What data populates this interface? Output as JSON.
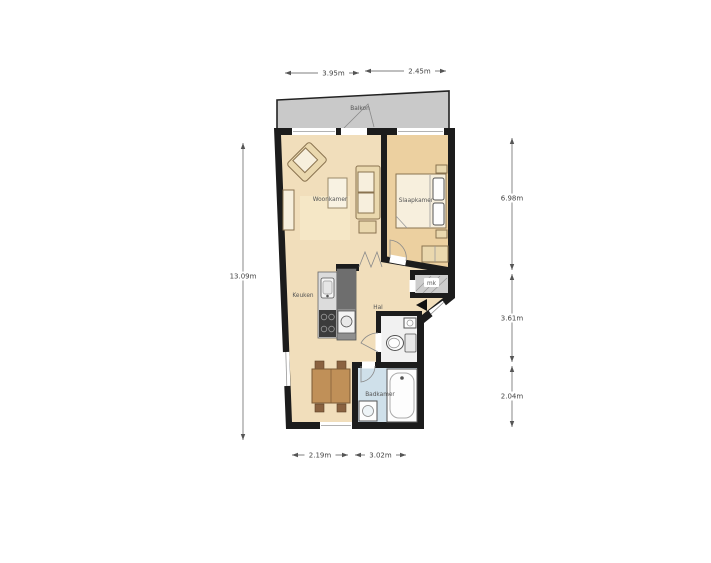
{
  "plan": {
    "rooms": {
      "balcony": "Balkon",
      "living_room": "Woonkamer",
      "bedroom": "Slaapkamer",
      "kitchen": "Keuken",
      "hall": "Hal",
      "bathroom": "Badkamer",
      "meter_closet": "mk"
    },
    "dimensions": {
      "top_left": "3.95m",
      "top_right": "2.45m",
      "left_total": "13.09m",
      "right_upper": "6.98m",
      "right_middle": "3.61m",
      "right_lower": "2.04m",
      "bottom_left": "2.19m",
      "bottom_right": "3.02m"
    },
    "colors": {
      "wall": "#1c1c1c",
      "floor_main": "#f1debb",
      "floor_bedroom": "#ecd0a0",
      "floor_bathroom": "#cfe0ea",
      "floor_toilet": "#f1f1f1",
      "balcony": "#c9c9c9",
      "furniture_fill": "#ead8ae",
      "furniture_stroke": "#8a7350",
      "wood_table": "#c09058",
      "wood_chair": "#8a6240",
      "counter_light": "#dcdcdc",
      "counter_dark": "#8f8f8f",
      "dim_line": "#555555",
      "label_text": "#555555"
    }
  }
}
